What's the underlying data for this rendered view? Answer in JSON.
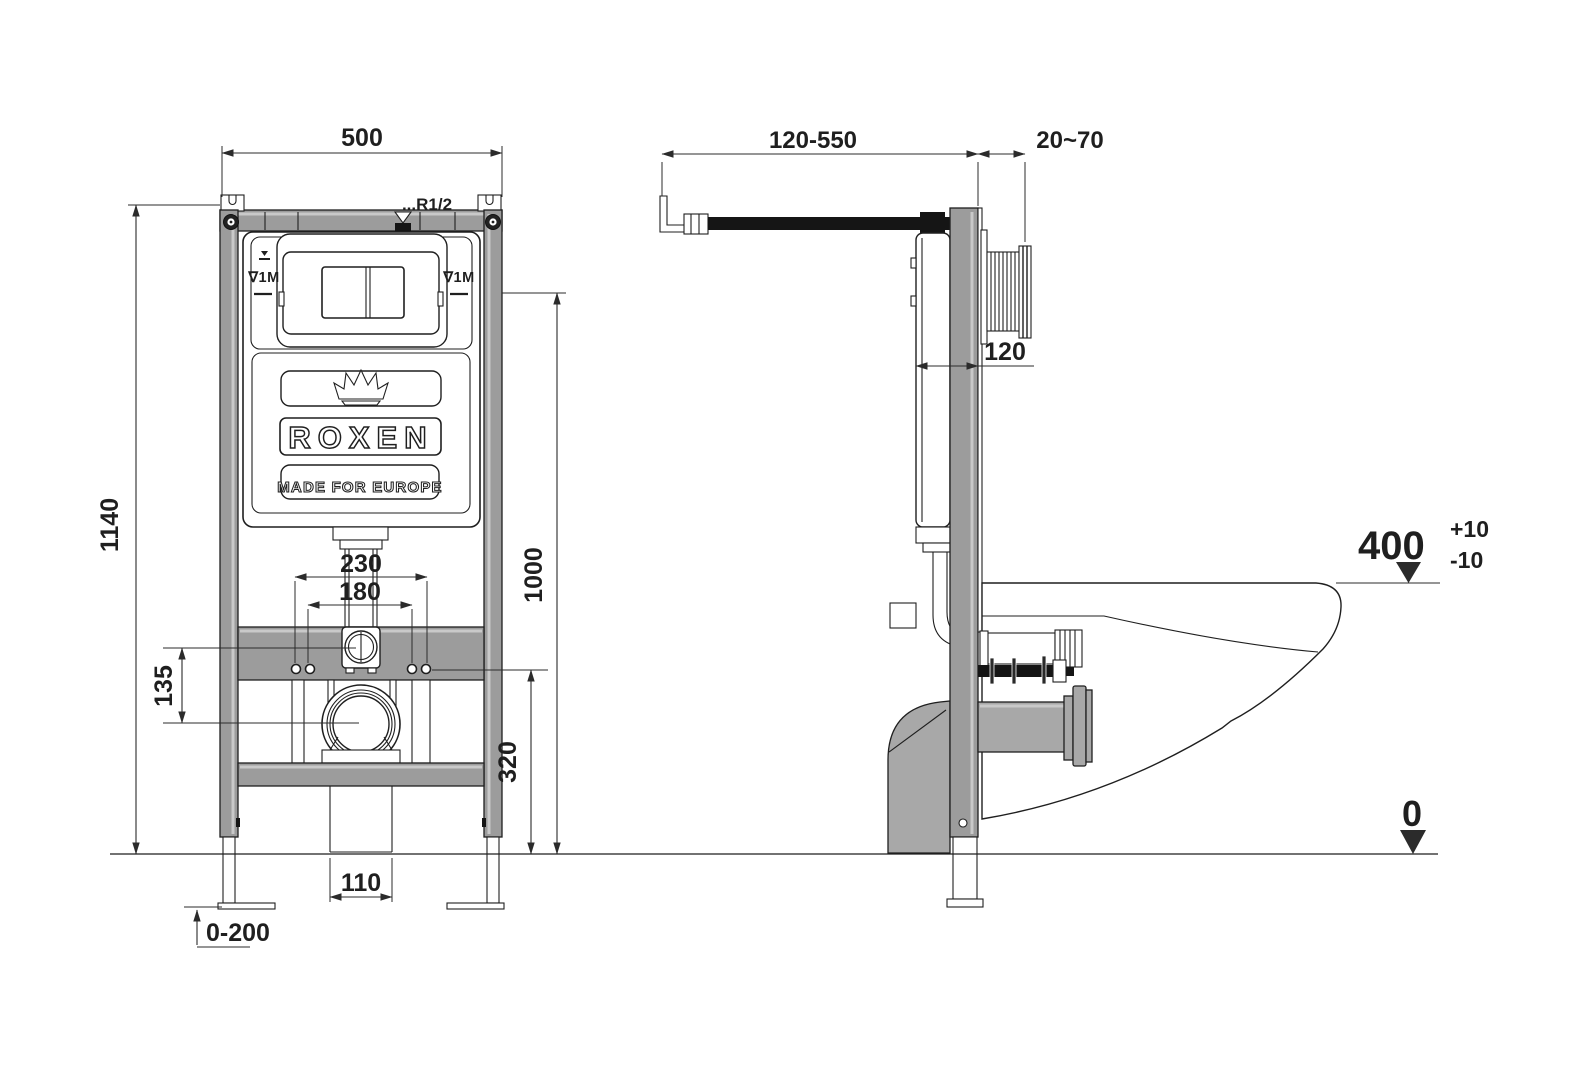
{
  "drawing": {
    "front_view": {
      "dim_width_top": "500",
      "dim_total_height": "1140",
      "dim_outer_holes": "230",
      "dim_inner_holes": "180",
      "dim_inlet_to_drain": "135",
      "dim_holes_height": "320",
      "dim_plate_height": "1000",
      "dim_drain_opening": "110",
      "dim_leg_adjust": "0-200",
      "label_water_supply": "...R1/2",
      "label_level_left": "∇1M",
      "label_level_right": "∇1M",
      "brand": "ROXEN",
      "brand_sub": "MADE FOR EUROPE"
    },
    "side_view": {
      "dim_supply_range": "120-550",
      "dim_wall_finish": "20~70",
      "dim_frame_depth": "120",
      "dim_bowl_height": "400",
      "dim_bowl_tol_plus": "+10",
      "dim_bowl_tol_minus": "-10",
      "dim_floor_level": "0"
    },
    "colors": {
      "frame_gray": "#9c9c9c",
      "line_color": "#1f1f1f",
      "pipe_black": "#151515"
    }
  }
}
